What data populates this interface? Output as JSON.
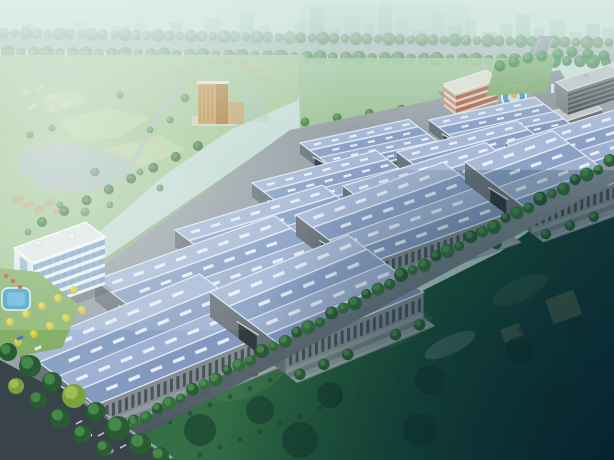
{
  "meta": {
    "description": "aerial-rendering-industrial-park",
    "canvas": {
      "w": 614,
      "h": 460
    }
  },
  "scene": {
    "palette": {
      "sky_top": "#d6e8e2",
      "sky_mid": "#c4dcd4",
      "city": "#9fbcbc",
      "city_dark": "#8bb0b2",
      "top_road": "#a0abb0",
      "curb": "#e8edf0",
      "park_green": "#a6c898",
      "park_light": "#c6dcaa",
      "park_pale": "#d2e2b4",
      "water": "#aebfc2",
      "sand": "#c9bd96",
      "ground": "#98a1a7",
      "flank": "#8fae83",
      "lawn": "#7fae6f",
      "field_a": "#356f46",
      "field_b": "#1d5138",
      "field_c": "#0c2e3a",
      "roof_light": "#a9bad8",
      "roof_mid": "#9fb1d2",
      "roof_dark": "#8ba1c6",
      "roof_dark2": "#8499c0",
      "roof_line": "#e6edf6",
      "skylight": "#eef4fa",
      "wall": "#848d94",
      "wall_base": "#9aa2a8",
      "wall_dark": "#6c757d",
      "slat": "#3e464d",
      "parapet": "#d6dbdf",
      "tree_dark": "#2a5c33",
      "tree_mid": "#35703c",
      "tree_lite": "#4e9350",
      "tree_yellow": "#d4c838",
      "pool": "#3f9cc8",
      "fountain_water": "#4f94c8",
      "fountain_rim": "#eef2f4",
      "gold": "#d8b050",
      "office_wall": "#eef1f4",
      "office_side": "#e9edf0",
      "office_roof": "#e4e8ec",
      "glass": "#7aa2c8",
      "asphalt": "#39444a",
      "lane": "#d8dde0",
      "sidewalk": "#b9c1c6",
      "plaza": "#8a939a",
      "entry_road": "#868f96",
      "red_wall": "#d8d2c2",
      "red_band": "#b05a40",
      "red_roof": "#e6e2d6",
      "red_side": "#e8e2d4",
      "dorm_wall": "#666c72",
      "dorm_side": "#7d848a",
      "dorm_roof": "#c2c6ca",
      "dorm_win": "#42474c",
      "tower_front": "#cf9c52",
      "tower_side": "#b07c38",
      "tower_wing": "#c8a068",
      "tower_cap": "#f0ece2",
      "shadow": "rgba(40,50,55,0.25)"
    },
    "city_blocks": [
      [
        0,
        18,
        14
      ],
      [
        22,
        12,
        22
      ],
      [
        40,
        16,
        10
      ],
      [
        60,
        10,
        18
      ],
      [
        75,
        14,
        26
      ],
      [
        95,
        12,
        12
      ],
      [
        112,
        18,
        20
      ],
      [
        135,
        10,
        30
      ],
      [
        150,
        16,
        16
      ],
      [
        170,
        12,
        24
      ],
      [
        186,
        14,
        12
      ],
      [
        205,
        16,
        28
      ],
      [
        225,
        10,
        16
      ],
      [
        240,
        14,
        34
      ],
      [
        258,
        12,
        20
      ],
      [
        275,
        16,
        12
      ],
      [
        295,
        10,
        26
      ],
      [
        310,
        14,
        40
      ],
      [
        328,
        12,
        18
      ],
      [
        344,
        16,
        30
      ],
      [
        364,
        10,
        22
      ],
      [
        378,
        14,
        44
      ],
      [
        396,
        12,
        26
      ],
      [
        412,
        16,
        16
      ],
      [
        432,
        12,
        34
      ],
      [
        448,
        14,
        20
      ],
      [
        466,
        10,
        28
      ],
      [
        482,
        16,
        14
      ],
      [
        500,
        12,
        22
      ],
      [
        516,
        14,
        32
      ],
      [
        534,
        10,
        18
      ],
      [
        550,
        16,
        26
      ],
      [
        570,
        12,
        14
      ],
      [
        586,
        14,
        22
      ],
      [
        602,
        12,
        18
      ]
    ],
    "top_road": {
      "band": [
        [
          0,
          36
        ],
        [
          614,
          46
        ],
        [
          614,
          62
        ],
        [
          0,
          50
        ]
      ],
      "tree_rows": 2,
      "tree_spacing": 11
    },
    "park": {
      "outline": [
        [
          0,
          55
        ],
        [
          305,
          55
        ],
        [
          298,
          100
        ],
        [
          230,
          130
        ],
        [
          165,
          175
        ],
        [
          90,
          240
        ],
        [
          0,
          325
        ]
      ],
      "lake": [
        [
          22,
          150
        ],
        [
          60,
          142
        ],
        [
          100,
          150
        ],
        [
          135,
          162
        ],
        [
          128,
          180
        ],
        [
          90,
          192
        ],
        [
          45,
          190
        ],
        [
          18,
          172
        ]
      ],
      "river": "M132,162 C150,140 150,120 165,105 C175,95 178,85 180,72",
      "patches": [
        [
          [
            60,
            120
          ],
          [
            110,
            108
          ],
          [
            150,
            118
          ],
          [
            120,
            138
          ],
          [
            75,
            140
          ]
        ],
        [
          [
            100,
            150
          ],
          [
            160,
            135
          ],
          [
            185,
            150
          ],
          [
            140,
            168
          ]
        ],
        [
          [
            38,
            98
          ],
          [
            78,
            90
          ],
          [
            90,
            102
          ],
          [
            52,
            112
          ]
        ]
      ],
      "white_slabs": [
        [
          20,
          92
        ],
        [
          34,
          88
        ],
        [
          48,
          96
        ],
        [
          28,
          106
        ],
        [
          44,
          110
        ],
        [
          60,
          104
        ]
      ],
      "tan_cluster": [
        [
          12,
          198
        ],
        [
          22,
          204
        ],
        [
          33,
          208
        ],
        [
          44,
          202
        ],
        [
          52,
          210
        ]
      ],
      "trees": [
        [
          30,
          135
        ],
        [
          52,
          128
        ],
        [
          150,
          130
        ],
        [
          170,
          120
        ],
        [
          185,
          98
        ],
        [
          120,
          95
        ],
        [
          95,
          172
        ],
        [
          140,
          172
        ],
        [
          60,
          205
        ],
        [
          85,
          212
        ],
        [
          110,
          205
        ],
        [
          160,
          188
        ],
        [
          28,
          232
        ],
        [
          48,
          242
        ]
      ],
      "edge_trees_from": [
        42,
        222
      ],
      "edge_trees_to": [
        198,
        146
      ],
      "edge_tree_count": 8
    },
    "tower": {
      "podium": [
        192,
        116,
        44,
        10
      ],
      "front": [
        198,
        84,
        18,
        40
      ],
      "side": [
        216,
        84,
        12,
        40
      ],
      "cap": [
        197,
        81,
        32,
        3
      ],
      "wing": [
        228,
        102,
        16,
        22
      ],
      "ghost_slabs": [
        [
          240,
          86,
          14,
          36
        ],
        [
          256,
          92,
          12,
          30
        ]
      ],
      "arc_buildings": [
        [
          178,
          70
        ],
        [
          190,
          64
        ],
        [
          205,
          60
        ],
        [
          222,
          59
        ],
        [
          238,
          62
        ],
        [
          250,
          68
        ],
        [
          258,
          76
        ]
      ]
    },
    "back_lawn": {
      "outline": [
        [
          298,
          58
        ],
        [
          548,
          58
        ],
        [
          540,
          88
        ],
        [
          470,
          108
        ],
        [
          300,
          128
        ]
      ],
      "trees_from": [
        305,
        122
      ],
      "trees_to": [
        530,
        92
      ],
      "tree_count": 8
    },
    "flank_strip": [
      [
        0,
        330
      ],
      [
        292,
        130
      ],
      [
        302,
        142
      ],
      [
        26,
        342
      ]
    ],
    "site_ground": [
      [
        0,
        340
      ],
      [
        290,
        130
      ],
      [
        548,
        76
      ],
      [
        614,
        96
      ],
      [
        614,
        185
      ],
      [
        90,
        458
      ],
      [
        0,
        395
      ]
    ],
    "field": {
      "outline": [
        [
          88,
          460
        ],
        [
          240,
          378
        ],
        [
          340,
          318
        ],
        [
          420,
          292
        ],
        [
          500,
          252
        ],
        [
          614,
          170
        ],
        [
          614,
          460
        ]
      ],
      "mounds": [
        [
          250,
          380,
          80,
          30
        ],
        [
          400,
          330,
          70,
          26
        ],
        [
          520,
          290,
          60,
          22
        ]
      ],
      "pond": [
        450,
        345,
        55,
        18
      ],
      "relics": [
        [
          545,
          300,
          30,
          26
        ],
        [
          500,
          330,
          20,
          14
        ]
      ],
      "clumps": [
        [
          200,
          430,
          16
        ],
        [
          260,
          410,
          14
        ],
        [
          330,
          395,
          13
        ],
        [
          430,
          380,
          15
        ],
        [
          520,
          350,
          14
        ],
        [
          580,
          330,
          12
        ],
        [
          300,
          440,
          18
        ],
        [
          420,
          430,
          17
        ],
        [
          560,
          400,
          16
        ]
      ],
      "dot_lines": [
        {
          "from": [
            150,
            430
          ],
          "to": [
            450,
            305
          ],
          "n": 16
        },
        {
          "from": [
            200,
            455
          ],
          "to": [
            520,
            330
          ],
          "n": 17
        }
      ]
    },
    "plaza": {
      "ground": [
        [
          438,
          92
        ],
        [
          560,
          70
        ],
        [
          584,
          112
        ],
        [
          470,
          128
        ]
      ],
      "fountain_center": [
        514,
        97
      ],
      "entry_road": [
        [
          538,
          36
        ],
        [
          554,
          36
        ],
        [
          530,
          100
        ],
        [
          506,
          98
        ]
      ],
      "stub_road": [
        [
          520,
          104
        ],
        [
          565,
          122
        ],
        [
          560,
          132
        ],
        [
          508,
          114
        ]
      ],
      "gate_posts": [
        [
          527,
          74
        ],
        [
          551,
          84
        ]
      ],
      "people": [
        [
          505,
          108
        ],
        [
          512,
          112
        ],
        [
          520,
          109
        ],
        [
          498,
          104
        ],
        [
          516,
          104
        ],
        [
          526,
          112
        ]
      ]
    },
    "red_building": {
      "x": 444,
      "y": 84,
      "len": 46,
      "wid": 16,
      "h": 22,
      "slope": 0.3,
      "floors": 3
    },
    "dorms": [
      {
        "x": 532,
        "y": 118,
        "len": 62,
        "wid": 18,
        "h": 26,
        "slope": 0.3
      },
      {
        "x": 556,
        "y": 82,
        "len": 58,
        "wid": 16,
        "h": 24,
        "slope": 0.3
      }
    ],
    "right_lawn": {
      "outline": [
        [
          496,
          60
        ],
        [
          556,
          54
        ],
        [
          546,
          92
        ],
        [
          486,
          96
        ]
      ],
      "trees": [
        [
          500,
          66
        ],
        [
          514,
          62
        ],
        [
          528,
          58
        ],
        [
          542,
          56
        ],
        [
          558,
          54
        ],
        [
          572,
          52
        ],
        [
          588,
          54
        ],
        [
          604,
          56
        ]
      ]
    },
    "warehouse_rows": [
      {
        "slope": 0.2,
        "wid": 52,
        "h": 11,
        "buildings": [
          [
            300,
            143,
            118
          ],
          [
            429,
            120,
            115
          ]
        ]
      },
      {
        "slope": 0.24,
        "wid": 62,
        "h": 14,
        "buildings": [
          [
            252,
            183,
            135
          ],
          [
            397,
            152,
            130
          ]
        ]
      },
      {
        "slope": 0.28,
        "wid": 76,
        "h": 17,
        "buildings": [
          [
            175,
            230,
            160
          ],
          [
            343,
            186,
            155
          ],
          [
            506,
            143,
            118
          ]
        ]
      },
      {
        "slope": 0.33,
        "wid": 90,
        "h": 21,
        "buildings": [
          [
            95,
            280,
            195
          ],
          [
            296,
            215,
            160
          ],
          [
            465,
            162,
            95
          ]
        ]
      },
      {
        "slope": 0.38,
        "wid": 102,
        "h": 25,
        "buildings": [
          [
            20,
            348,
            195
          ],
          [
            210,
            292,
            150
          ]
        ]
      }
    ],
    "office": {
      "x": 14,
      "y": 248,
      "len": 78,
      "wid": 26,
      "h": 48,
      "slope": 0.33,
      "floors": 5
    },
    "garden": {
      "outline": [
        [
          0,
          268
        ],
        [
          38,
          272
        ],
        [
          80,
          306
        ],
        [
          62,
          348
        ],
        [
          0,
          360
        ]
      ],
      "pool": [
        2,
        288,
        28,
        22
      ],
      "yellow_trees": [
        [
          10,
          322
        ],
        [
          26,
          314
        ],
        [
          42,
          306
        ],
        [
          58,
          298
        ],
        [
          74,
          290
        ],
        [
          18,
          342
        ],
        [
          34,
          334
        ],
        [
          50,
          326
        ],
        [
          66,
          318
        ],
        [
          82,
          310
        ]
      ],
      "red_dots": [
        [
          6,
          276
        ],
        [
          13,
          281
        ],
        [
          20,
          287
        ]
      ],
      "cars": [
        [
          20,
          338
        ],
        [
          38,
          348
        ]
      ]
    },
    "boundary_road": {
      "poly": [
        [
          70,
          460
        ],
        [
          606,
          162
        ],
        [
          614,
          166
        ],
        [
          614,
          182
        ],
        [
          98,
          460
        ]
      ],
      "tree_line": [
        [
          88,
          452
        ],
        [
          610,
          166
        ]
      ],
      "tree_spacing": 13
    },
    "sw_road": {
      "poly": [
        [
          0,
          360
        ],
        [
          80,
          402
        ],
        [
          170,
          460
        ],
        [
          0,
          460
        ]
      ],
      "dashes": [
        [
          120,
          448
        ],
        [
          98,
          436
        ],
        [
          76,
          424
        ],
        [
          54,
          412
        ],
        [
          32,
          400
        ],
        [
          14,
          390
        ]
      ],
      "sidewalk": [
        [
          80,
          398
        ],
        [
          172,
          458
        ]
      ],
      "cars": [
        {
          "p": [
            88,
            436
          ],
          "c": "#e8e8e8"
        },
        {
          "p": [
            58,
            414
          ],
          "c": "#b03830"
        },
        {
          "p": [
            110,
            452
          ],
          "c": "#8a929a"
        }
      ],
      "trees": [
        [
          8,
          352,
          9
        ],
        [
          30,
          366,
          11
        ],
        [
          52,
          382,
          10
        ],
        [
          74,
          396,
          12
        ],
        [
          96,
          412,
          10
        ],
        [
          118,
          428,
          12
        ],
        [
          140,
          444,
          11
        ],
        [
          160,
          456,
          9
        ],
        [
          16,
          386,
          8
        ],
        [
          38,
          400,
          9
        ],
        [
          60,
          418,
          10
        ],
        [
          82,
          434,
          9
        ],
        [
          104,
          448,
          8
        ]
      ]
    }
  }
}
